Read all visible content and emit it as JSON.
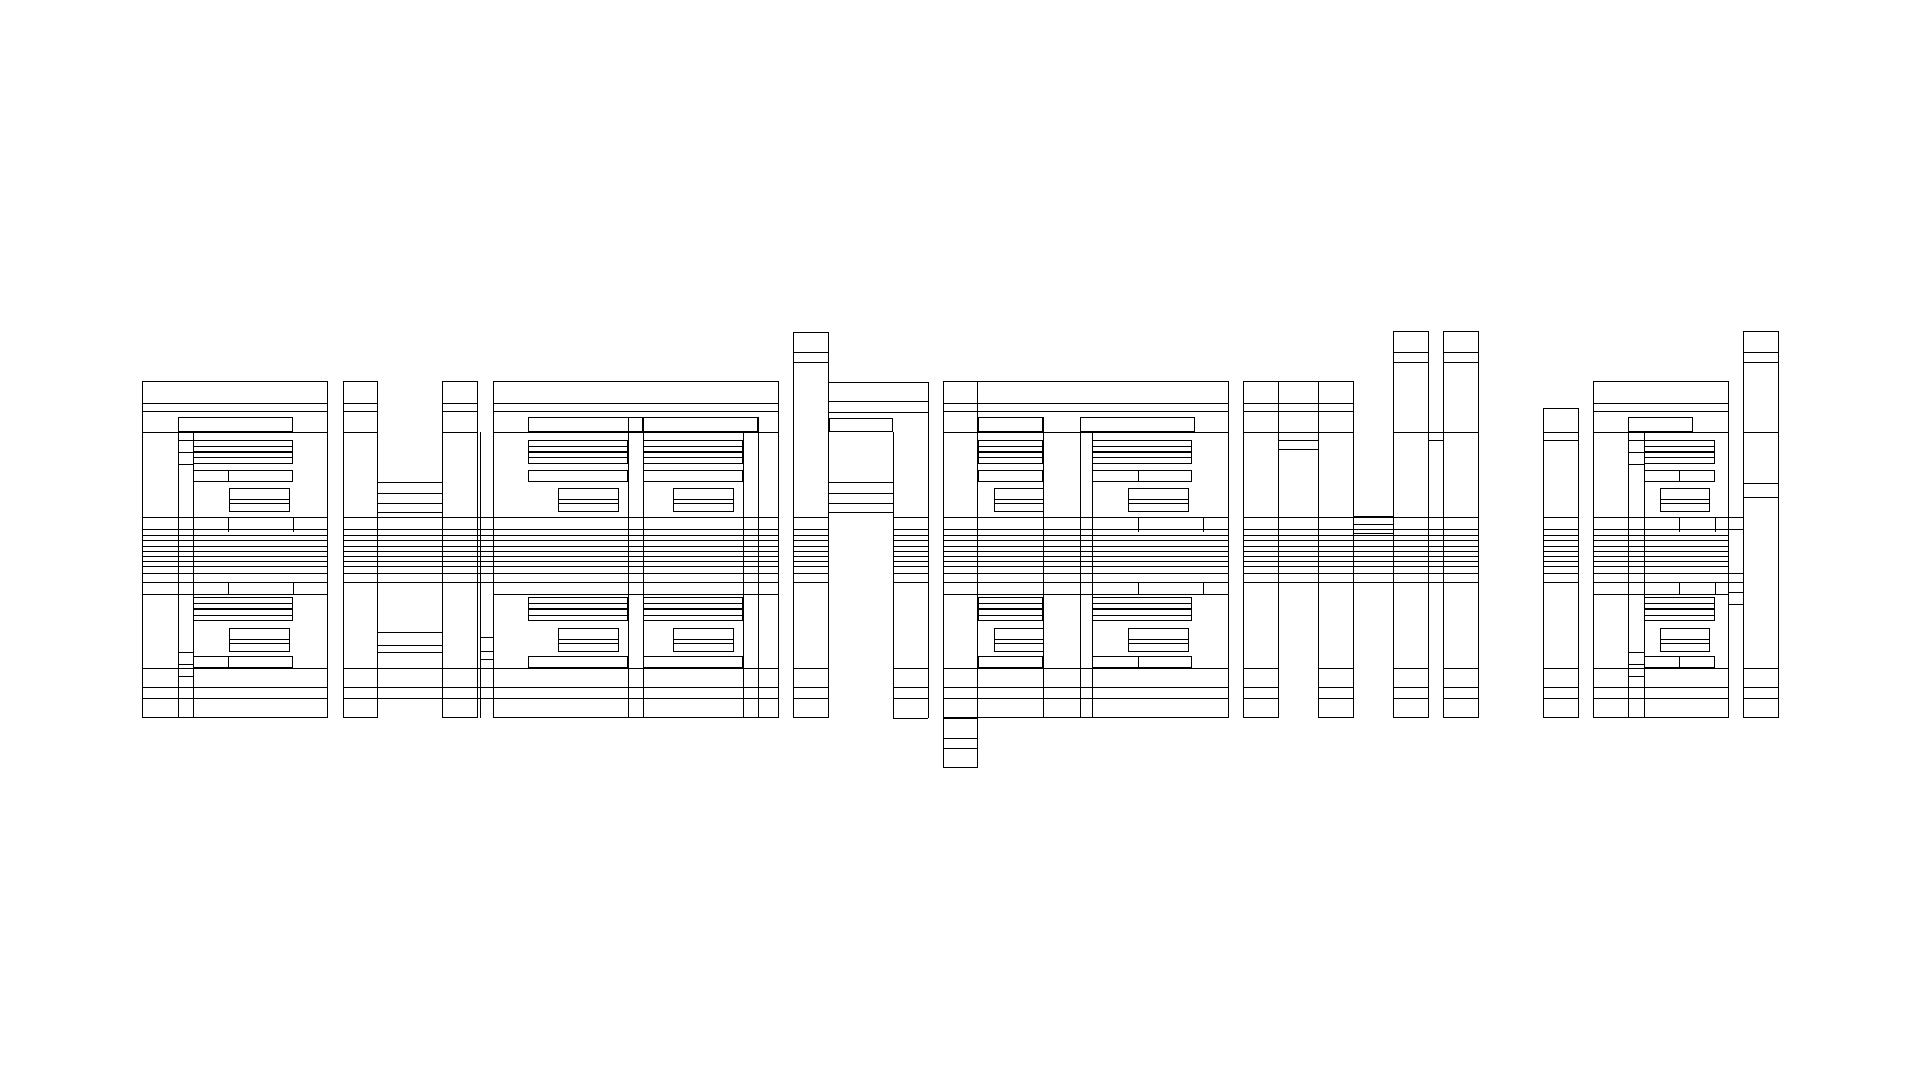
{
  "canvas": {
    "width": 1920,
    "height": 1080,
    "background": "#ffffff",
    "stroke": "#000000"
  },
  "artwork": {
    "description": "abstract-nested-rectangle-line-art",
    "rects": [
      [
        142,
        381,
        186,
        337
      ],
      [
        178,
        417,
        115,
        15
      ],
      [
        193,
        440,
        100,
        12
      ],
      [
        193,
        452,
        100,
        12
      ],
      [
        193,
        470,
        100,
        12
      ],
      [
        229,
        488,
        61,
        24
      ],
      [
        193,
        597,
        100,
        12
      ],
      [
        193,
        609,
        100,
        12
      ],
      [
        229,
        628,
        61,
        24
      ],
      [
        193,
        656,
        100,
        12
      ],
      [
        343,
        381,
        35,
        337
      ],
      [
        442,
        381,
        36,
        337
      ],
      [
        493,
        381,
        286,
        337
      ],
      [
        528,
        417,
        115,
        15
      ],
      [
        528,
        440,
        100,
        12
      ],
      [
        528,
        452,
        100,
        12
      ],
      [
        528,
        470,
        100,
        12
      ],
      [
        558,
        488,
        61,
        24
      ],
      [
        528,
        597,
        100,
        12
      ],
      [
        528,
        609,
        100,
        12
      ],
      [
        558,
        628,
        61,
        24
      ],
      [
        528,
        656,
        100,
        12
      ],
      [
        643,
        417,
        115,
        15
      ],
      [
        643,
        440,
        100,
        12
      ],
      [
        643,
        452,
        100,
        12
      ],
      [
        643,
        470,
        100,
        12
      ],
      [
        673,
        488,
        61,
        24
      ],
      [
        643,
        597,
        100,
        12
      ],
      [
        643,
        609,
        100,
        12
      ],
      [
        673,
        628,
        61,
        24
      ],
      [
        643,
        656,
        100,
        12
      ],
      [
        793,
        332,
        36,
        386
      ],
      [
        829,
        418,
        64,
        14
      ],
      [
        943,
        381,
        286,
        337
      ],
      [
        943,
        381,
        35,
        387
      ],
      [
        978,
        417,
        65,
        15
      ],
      [
        978,
        440,
        65,
        12
      ],
      [
        978,
        452,
        65,
        12
      ],
      [
        978,
        470,
        65,
        12
      ],
      [
        994,
        488,
        50,
        24
      ],
      [
        978,
        597,
        65,
        12
      ],
      [
        978,
        609,
        65,
        12
      ],
      [
        994,
        628,
        50,
        24
      ],
      [
        978,
        656,
        65,
        12
      ],
      [
        1080,
        417,
        115,
        15
      ],
      [
        1092,
        440,
        100,
        12
      ],
      [
        1092,
        452,
        100,
        12
      ],
      [
        1092,
        470,
        100,
        12
      ],
      [
        1128,
        488,
        61,
        24
      ],
      [
        1092,
        597,
        100,
        12
      ],
      [
        1092,
        609,
        100,
        12
      ],
      [
        1128,
        628,
        61,
        24
      ],
      [
        1092,
        656,
        100,
        12
      ],
      [
        1243,
        381,
        36,
        337
      ],
      [
        1318,
        381,
        36,
        337
      ],
      [
        1393,
        331,
        36,
        387
      ],
      [
        1443,
        331,
        36,
        387
      ],
      [
        1543,
        408,
        36,
        310
      ],
      [
        1593,
        381,
        136,
        337
      ],
      [
        1628,
        417,
        65,
        15
      ],
      [
        1644,
        440,
        71,
        12
      ],
      [
        1644,
        452,
        71,
        12
      ],
      [
        1644,
        470,
        71,
        12
      ],
      [
        1660,
        488,
        50,
        24
      ],
      [
        1644,
        597,
        71,
        12
      ],
      [
        1644,
        609,
        71,
        12
      ],
      [
        1660,
        628,
        50,
        24
      ],
      [
        1644,
        656,
        71,
        12
      ],
      [
        1743,
        331,
        36,
        387
      ]
    ],
    "hlines": [
      [
        193,
        446,
        100
      ],
      [
        193,
        457,
        100
      ],
      [
        229,
        499,
        61
      ],
      [
        229,
        503,
        61
      ],
      [
        142,
        594,
        186
      ],
      [
        193,
        603,
        100
      ],
      [
        193,
        615,
        100
      ],
      [
        229,
        639,
        61
      ],
      [
        229,
        643,
        61
      ],
      [
        178,
        440,
        15
      ],
      [
        178,
        452,
        15
      ],
      [
        178,
        464,
        15
      ],
      [
        178,
        652,
        15
      ],
      [
        178,
        664,
        15
      ],
      [
        178,
        676,
        15
      ],
      [
        378,
        632,
        64
      ],
      [
        378,
        645,
        64
      ],
      [
        378,
        652,
        64
      ],
      [
        528,
        446,
        100
      ],
      [
        528,
        457,
        100
      ],
      [
        643,
        446,
        100
      ],
      [
        643,
        457,
        100
      ],
      [
        558,
        499,
        61
      ],
      [
        558,
        503,
        61
      ],
      [
        673,
        499,
        61
      ],
      [
        673,
        503,
        61
      ],
      [
        493,
        594,
        286
      ],
      [
        528,
        603,
        100
      ],
      [
        528,
        615,
        100
      ],
      [
        643,
        603,
        100
      ],
      [
        643,
        615,
        100
      ],
      [
        558,
        639,
        61
      ],
      [
        558,
        643,
        61
      ],
      [
        673,
        639,
        61
      ],
      [
        673,
        643,
        61
      ],
      [
        480,
        637,
        13
      ],
      [
        480,
        651,
        13
      ],
      [
        480,
        659,
        13
      ],
      [
        829,
        382,
        99
      ],
      [
        829,
        401,
        99
      ],
      [
        829,
        412,
        99
      ],
      [
        893,
        718,
        35
      ],
      [
        978,
        446,
        65
      ],
      [
        978,
        457,
        65
      ],
      [
        1092,
        446,
        100
      ],
      [
        1092,
        457,
        100
      ],
      [
        994,
        499,
        50
      ],
      [
        994,
        503,
        50
      ],
      [
        1128,
        499,
        61
      ],
      [
        1128,
        503,
        61
      ],
      [
        943,
        594,
        286
      ],
      [
        978,
        603,
        65
      ],
      [
        978,
        615,
        65
      ],
      [
        1092,
        603,
        100
      ],
      [
        1092,
        615,
        100
      ],
      [
        994,
        639,
        50
      ],
      [
        994,
        643,
        50
      ],
      [
        1128,
        639,
        61
      ],
      [
        1128,
        643,
        61
      ],
      [
        943,
        718,
        35
      ],
      [
        943,
        738,
        35
      ],
      [
        943,
        748,
        35
      ],
      [
        1279,
        381,
        39
      ],
      [
        1279,
        440,
        39
      ],
      [
        1279,
        449,
        39
      ],
      [
        1354,
        516,
        39
      ],
      [
        1354,
        524,
        39
      ],
      [
        1354,
        533,
        39
      ],
      [
        1429,
        432,
        14
      ],
      [
        1429,
        440,
        14
      ],
      [
        1393,
        432,
        36
      ],
      [
        1443,
        432,
        36
      ],
      [
        1543,
        432,
        36
      ],
      [
        1543,
        440,
        36
      ],
      [
        1644,
        446,
        71
      ],
      [
        1644,
        457,
        71
      ],
      [
        1660,
        499,
        50
      ],
      [
        1660,
        503,
        50
      ],
      [
        1593,
        594,
        136
      ],
      [
        1644,
        603,
        71
      ],
      [
        1644,
        615,
        71
      ],
      [
        1660,
        639,
        50
      ],
      [
        1660,
        643,
        50
      ],
      [
        1628,
        440,
        16
      ],
      [
        1628,
        452,
        16
      ],
      [
        1628,
        464,
        16
      ],
      [
        1628,
        652,
        16
      ],
      [
        1628,
        664,
        16
      ],
      [
        1628,
        676,
        16
      ],
      [
        1743,
        432,
        36
      ],
      [
        1743,
        483,
        36
      ],
      [
        1743,
        497,
        36
      ],
      [
        1729,
        517,
        14
      ],
      [
        1729,
        529,
        14
      ],
      [
        1729,
        573,
        14
      ],
      [
        1729,
        582,
        14
      ],
      [
        1729,
        592,
        14
      ],
      [
        1729,
        604,
        14
      ]
    ],
    "vlines": [
      [
        178,
        417,
        301
      ],
      [
        193,
        432,
        286
      ],
      [
        228,
        470,
        12
      ],
      [
        228,
        517,
        15
      ],
      [
        293,
        517,
        15
      ],
      [
        228,
        582,
        12
      ],
      [
        293,
        582,
        12
      ],
      [
        228,
        656,
        12
      ],
      [
        480,
        432,
        286
      ],
      [
        628,
        417,
        301
      ],
      [
        643,
        417,
        301
      ],
      [
        758,
        417,
        301
      ],
      [
        743,
        432,
        286
      ],
      [
        893,
        432,
        286
      ],
      [
        928,
        382,
        336
      ],
      [
        1043,
        417,
        301
      ],
      [
        1080,
        417,
        301
      ],
      [
        1092,
        432,
        286
      ],
      [
        1138,
        470,
        12
      ],
      [
        1138,
        517,
        15
      ],
      [
        1203,
        517,
        15
      ],
      [
        1138,
        582,
        12
      ],
      [
        1203,
        582,
        12
      ],
      [
        1138,
        656,
        12
      ],
      [
        1628,
        417,
        301
      ],
      [
        1644,
        432,
        286
      ],
      [
        1679,
        470,
        12
      ],
      [
        1679,
        517,
        15
      ],
      [
        1715,
        517,
        15
      ],
      [
        1679,
        582,
        12
      ],
      [
        1715,
        582,
        12
      ],
      [
        1679,
        656,
        12
      ]
    ],
    "bands": [
      {
        "name": "mid-stripes",
        "rows": [
          517,
          529,
          535,
          540,
          546,
          551,
          556,
          561,
          566,
          573,
          582
        ],
        "spans": [
          [
            142,
            186
          ],
          [
            343,
            436
          ],
          [
            793,
            36
          ],
          [
            893,
            35
          ],
          [
            943,
            286
          ],
          [
            1243,
            236
          ],
          [
            1543,
            36
          ],
          [
            1593,
            136
          ]
        ]
      },
      {
        "name": "top-band",
        "rows": [
          403,
          411,
          432
        ],
        "spans": [
          [
            142,
            186
          ],
          [
            343,
            35
          ],
          [
            442,
            36
          ],
          [
            493,
            286
          ],
          [
            943,
            286
          ],
          [
            1243,
            111
          ],
          [
            1593,
            136
          ]
        ]
      },
      {
        "name": "bottom-band",
        "rows": [
          668,
          687,
          698
        ],
        "spans": [
          [
            142,
            186
          ],
          [
            343,
            150
          ],
          [
            493,
            286
          ],
          [
            793,
            36
          ],
          [
            893,
            35
          ],
          [
            943,
            286
          ],
          [
            1243,
            36
          ],
          [
            1318,
            36
          ],
          [
            1393,
            36
          ],
          [
            1443,
            36
          ],
          [
            1543,
            36
          ],
          [
            1593,
            136
          ],
          [
            1743,
            36
          ]
        ]
      },
      {
        "name": "ascender-cells",
        "rows": [
          352,
          362
        ],
        "spans": [
          [
            793,
            36
          ],
          [
            1393,
            36
          ],
          [
            1443,
            36
          ],
          [
            1743,
            36
          ]
        ]
      },
      {
        "name": "arch-cells",
        "rows": [
          482,
          493,
          503,
          512
        ],
        "spans": [
          [
            378,
            64
          ],
          [
            829,
            64
          ]
        ]
      }
    ]
  }
}
